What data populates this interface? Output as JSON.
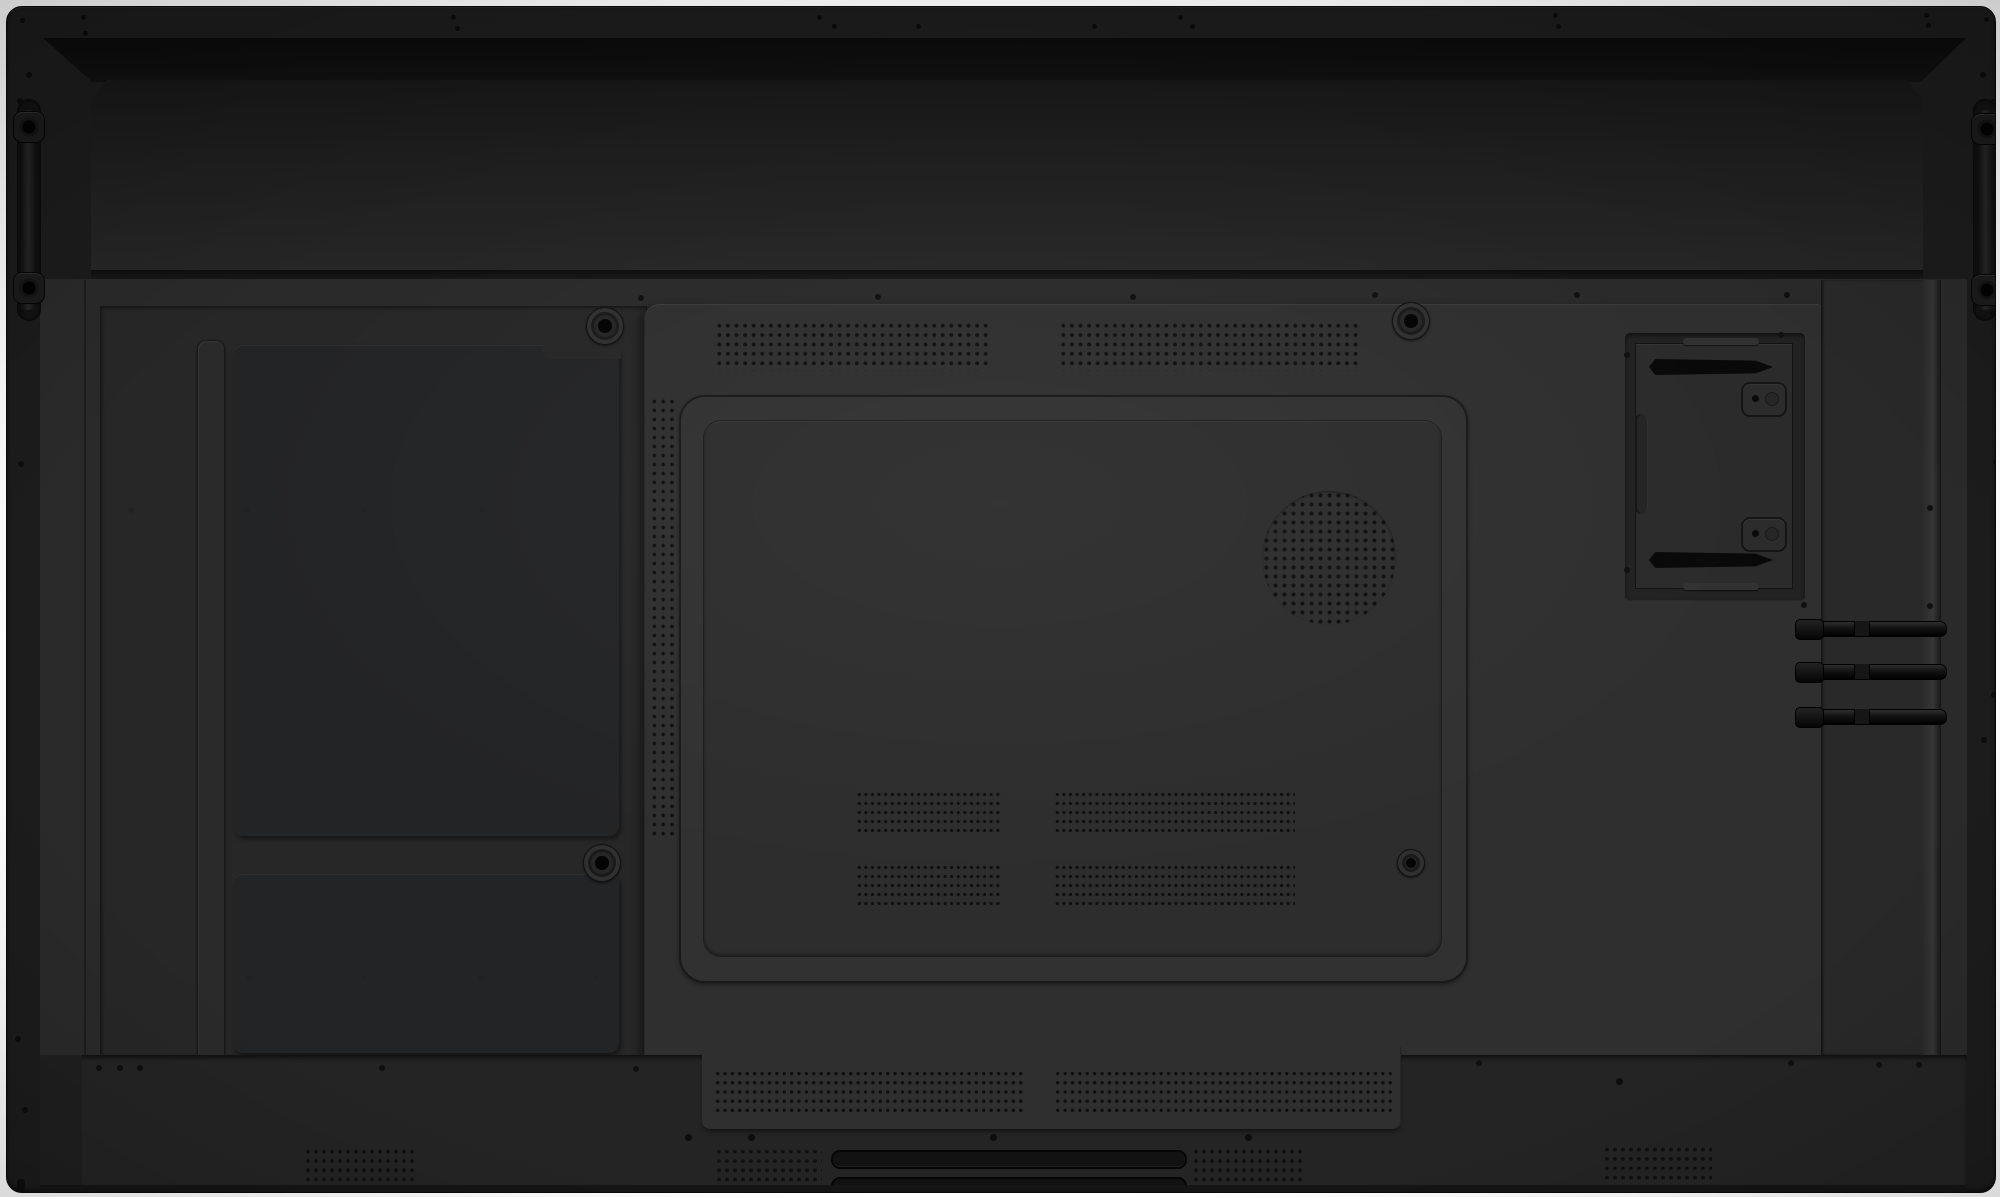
{
  "meta": {
    "title": "Rear view of a large interactive flat-panel display chassis",
    "background": "#ffffff"
  },
  "palette": {
    "background": "#ffffff",
    "shell": "#1c1c1c",
    "shell_edge": "#0a0a0a",
    "recess_band": "#0d0d0d",
    "top_bulge": "#1e1e1e",
    "back_surface": "#2a2a2a",
    "left_recess": "#272727",
    "panel": "#232426",
    "plate": "#2f2f2f",
    "access_panel": "#2d2d2d",
    "bottom_band": "#242424",
    "bracket": "#2b2b2b",
    "antenna": "#121212",
    "dot": "#0f0f0f",
    "faint_dot": "#212121",
    "slot": "#121212"
  },
  "labels": {
    "device": "flat panel display rear cover",
    "top_bulge": "top speaker/electronics compartment",
    "left_handle": "left recessed carry handle",
    "right_handle": "right recessed carry handle",
    "upper_left_panel": "upper left service panel",
    "lower_left_panel": "lower left service panel",
    "center_plate": "central mounting plate",
    "access_panel": "rear access panel",
    "speaker": "round speaker perforation",
    "ops_bracket": "OPS module bracket with mounting slots",
    "antennas": "three fold-out antenna rods",
    "handle_slots": "bottom handle slots",
    "screw": "screw hole",
    "vent": "perforated ventilation grid"
  },
  "grids": {
    "top_left": {
      "x": 708,
      "y": 314,
      "w": 276,
      "h": 50,
      "px": 8.6,
      "py": 9.4,
      "d": 3.4
    },
    "top_right": {
      "x": 1052,
      "y": 314,
      "w": 302,
      "h": 50,
      "px": 8.6,
      "py": 9.4,
      "d": 3.4
    },
    "left_strip": {
      "x": 643,
      "y": 390,
      "w": 27,
      "h": 442,
      "px": 8.8,
      "py": 9,
      "d": 3.2
    },
    "speaker": {
      "x": 1255,
      "y": 484,
      "w": 134,
      "h": 134,
      "px": 9,
      "py": 9,
      "d": 3.6,
      "round": true
    },
    "pb1": {
      "x": 849,
      "y": 783,
      "w": 147,
      "h": 45,
      "px": 6.6,
      "py": 9,
      "d": 2.8
    },
    "pb2": {
      "x": 1047,
      "y": 783,
      "w": 241,
      "h": 45,
      "px": 6.6,
      "py": 9,
      "d": 2.8
    },
    "pb3": {
      "x": 849,
      "y": 856,
      "w": 147,
      "h": 48,
      "px": 6.6,
      "py": 9,
      "d": 2.8
    },
    "pb4": {
      "x": 1047,
      "y": 856,
      "w": 241,
      "h": 48,
      "px": 6.6,
      "py": 9,
      "d": 2.8
    },
    "st1": {
      "x": 707,
      "y": 1062,
      "w": 310,
      "h": 46,
      "px": 7.4,
      "py": 9.2,
      "d": 3
    },
    "st2": {
      "x": 1047,
      "y": 1062,
      "w": 340,
      "h": 46,
      "px": 7.4,
      "py": 9.2,
      "d": 3
    },
    "bg1": {
      "x": 297,
      "y": 1140,
      "w": 110,
      "h": 48,
      "px": 8,
      "py": 9.3,
      "d": 3.2
    },
    "bg2": {
      "x": 708,
      "y": 1140,
      "w": 107,
      "h": 48,
      "px": 8,
      "py": 9.3,
      "d": 3.2
    },
    "bg3": {
      "x": 1185,
      "y": 1140,
      "w": 113,
      "h": 48,
      "px": 8,
      "py": 9.3,
      "d": 3.2
    },
    "bg4": {
      "x": 1596,
      "y": 1138,
      "w": 109,
      "h": 48,
      "px": 8,
      "py": 9.3,
      "d": 3.2
    }
  },
  "dots": {
    "top_lip": {
      "d": 5,
      "c": "#0b0b0b",
      "pts": [
        [
          15,
          13
        ],
        [
          76,
          10
        ],
        [
          78,
          26
        ],
        [
          446,
          10
        ],
        [
          450,
          21
        ],
        [
          812,
          10
        ],
        [
          827,
          19
        ],
        [
          911,
          19
        ],
        [
          1087,
          19
        ],
        [
          1173,
          10
        ],
        [
          1185,
          19
        ],
        [
          1548,
          8
        ],
        [
          1551,
          19
        ],
        [
          1919,
          8
        ],
        [
          1921,
          18
        ],
        [
          1979,
          12
        ]
      ]
    },
    "upper_row": {
      "d": 6,
      "c": "#101010",
      "pts": [
        [
          634,
          291
        ],
        [
          871,
          290
        ],
        [
          1126,
          290
        ],
        [
          1368,
          288
        ],
        [
          1570,
          288
        ],
        [
          1780,
          288
        ]
      ]
    },
    "left_margin": {
      "d": 6,
      "c": "#0c0c0c",
      "pts": [
        [
          22,
          68
        ],
        [
          13,
          94
        ],
        [
          13,
          305
        ],
        [
          14,
          457
        ],
        [
          11,
          1032
        ],
        [
          18,
          1103
        ]
      ]
    },
    "right_margin": {
      "d": 6,
      "c": "#0c0c0c",
      "pts": [
        [
          1976,
          68
        ],
        [
          1986,
          95
        ],
        [
          1986,
          306
        ],
        [
          1989,
          455
        ],
        [
          1987,
          688
        ],
        [
          1977,
          733
        ],
        [
          1990,
          1078
        ]
      ]
    },
    "plate_misc": {
      "d": 6,
      "c": "#101010",
      "pts": [
        [
          1797,
          598
        ],
        [
          1923,
          501
        ],
        [
          1923,
          599
        ],
        [
          1620,
          348
        ],
        [
          1774,
          328
        ],
        [
          1620,
          563
        ]
      ]
    },
    "band_upper": {
      "d": 6,
      "c": "#0f0f0f",
      "pts": [
        [
          92,
          1061
        ],
        [
          113,
          1061
        ],
        [
          133,
          1061
        ],
        [
          375,
          1061
        ],
        [
          629,
          1062
        ],
        [
          1472,
          1056
        ],
        [
          1784,
          1056
        ],
        [
          1872,
          1058
        ],
        [
          1912,
          1058
        ]
      ]
    },
    "band_lower": {
      "d": 7,
      "c": "#0d0d0d",
      "pts": [
        [
          681,
          1130
        ],
        [
          744,
          1130
        ],
        [
          986,
          1130
        ],
        [
          1241,
          1130
        ],
        [
          1612,
          1074
        ]
      ]
    },
    "faint": {
      "d": 5,
      "c": "#222222",
      "pts": [
        [
          124,
          503
        ],
        [
          240,
          503
        ],
        [
          356,
          503
        ],
        [
          475,
          503
        ],
        [
          241,
          970
        ],
        [
          357,
          970
        ],
        [
          473,
          970
        ],
        [
          589,
          970
        ]
      ]
    }
  }
}
